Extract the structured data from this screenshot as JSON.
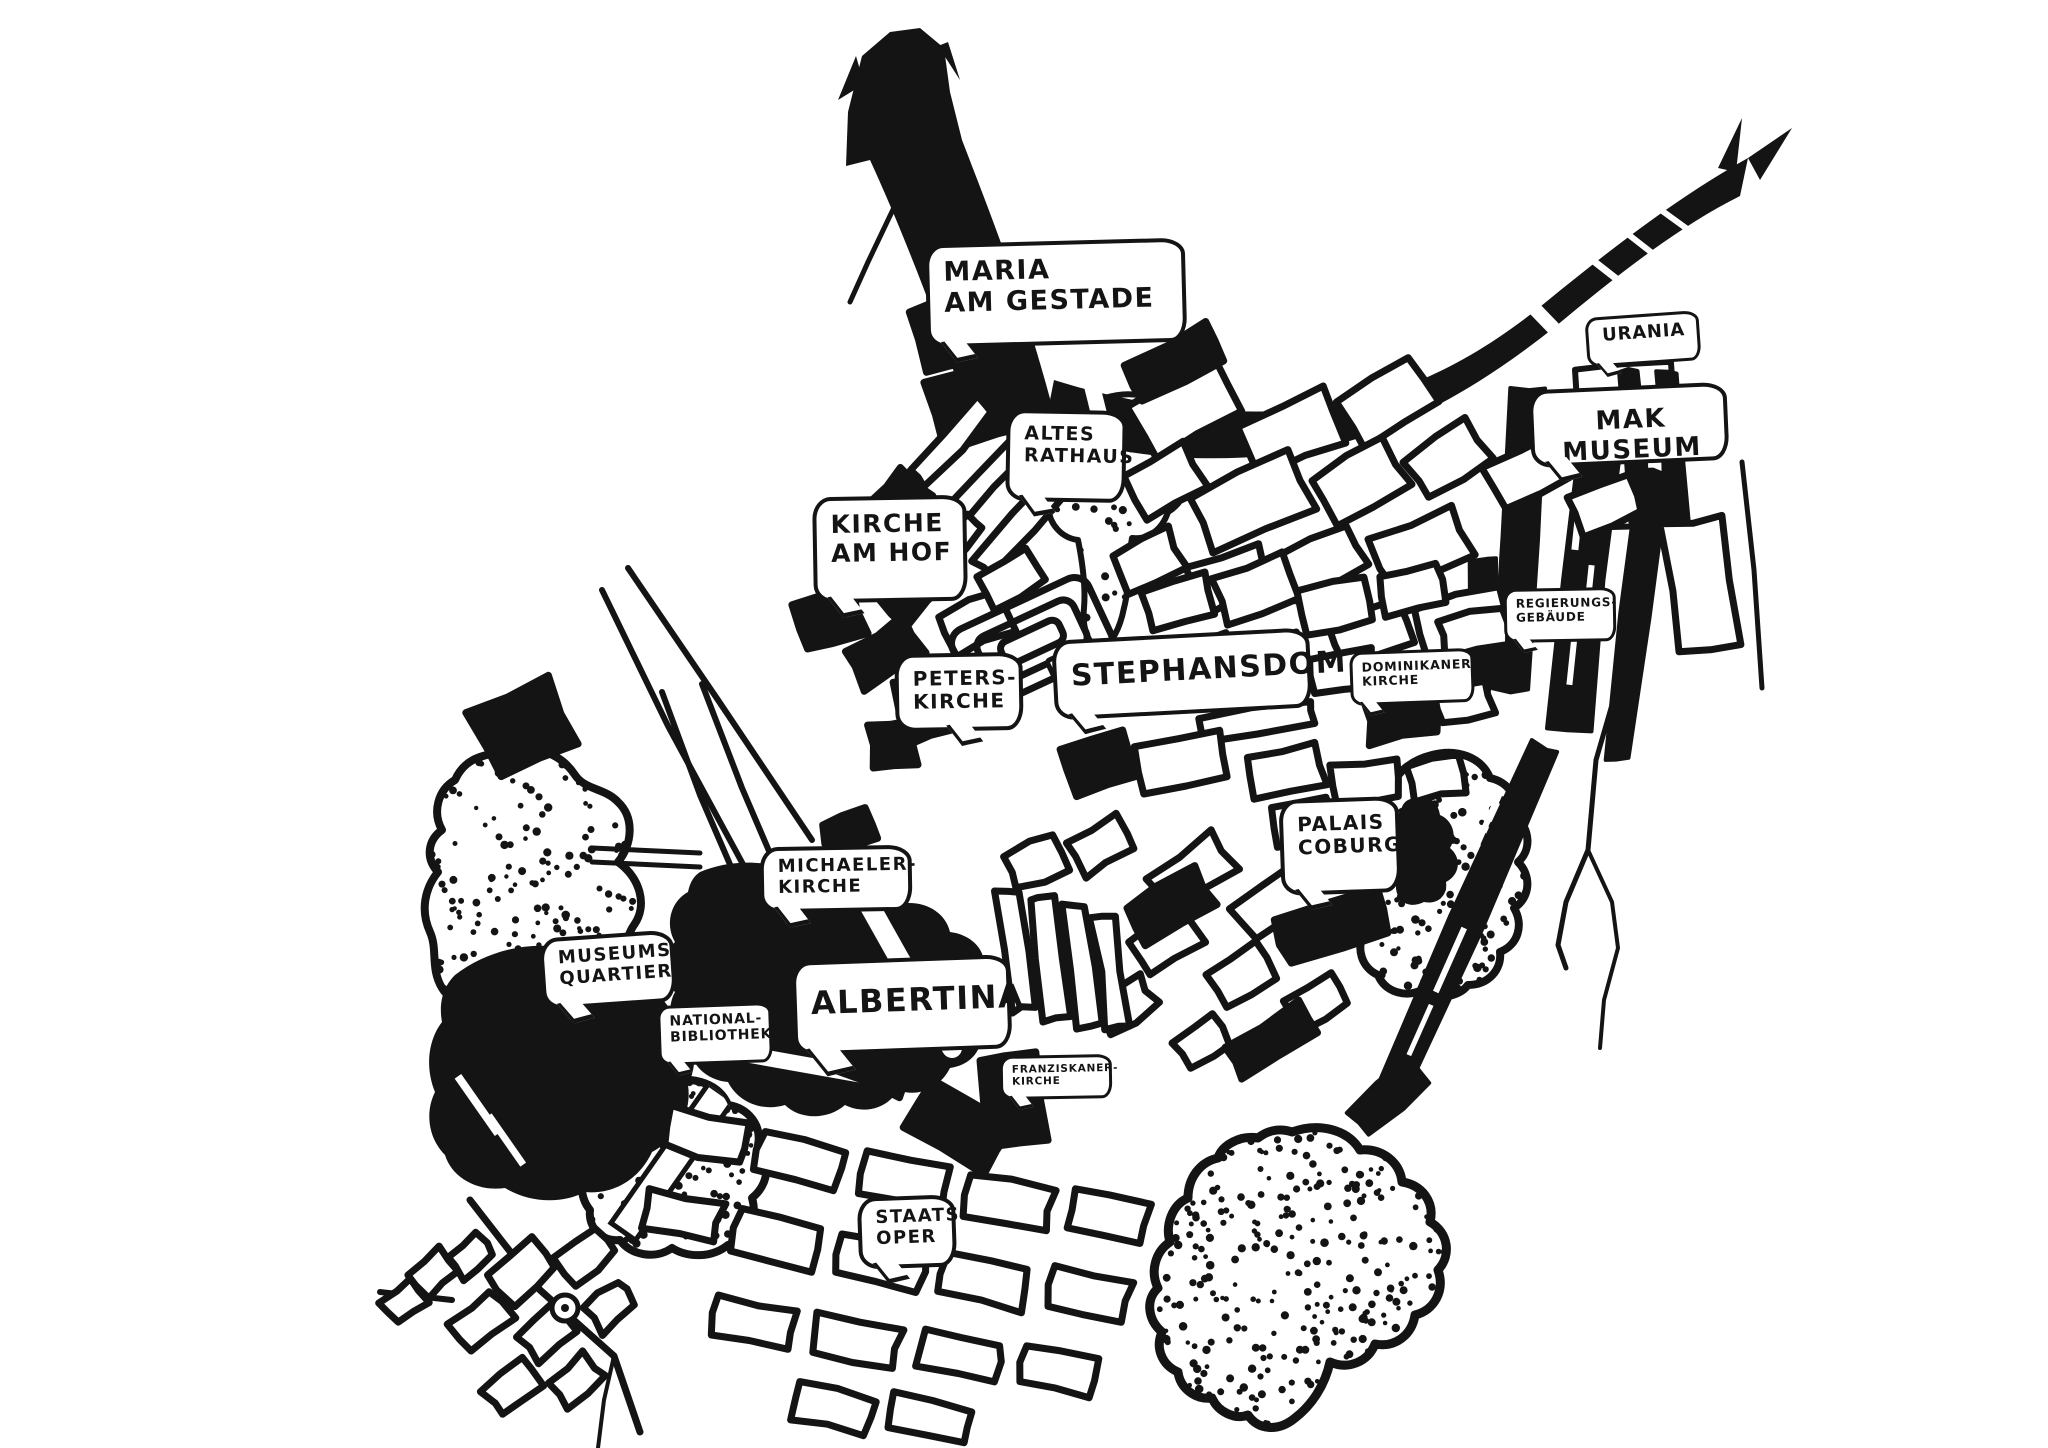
{
  "map": {
    "kind": "hand-drawn ink map",
    "city_center": "Vienna Innere Stadt"
  },
  "colors": {
    "ink": "#141414",
    "paper": "#ffffff"
  },
  "labels": {
    "maria_am_gestade": {
      "line1": "MARIA",
      "line2": "AM GESTADE"
    },
    "urania": {
      "line1": "URANIA"
    },
    "mak_museum": {
      "line1": "MAK MUSEUM"
    },
    "altes_rathaus": {
      "line1": "ALTES",
      "line2": "RATHAUS"
    },
    "kirche_am_hof": {
      "line1": "KIRCHE",
      "line2": "AM HOF"
    },
    "regierungsgebaeude": {
      "line1": "REGIERUNGS-",
      "line2": "GEBÄUDE"
    },
    "peterskirche": {
      "line1": "PETERS-",
      "line2": "KIRCHE"
    },
    "stephansdom": {
      "line1": "STEPHANSDOM"
    },
    "dominikanerkirche": {
      "line1": "DOMINIKANER-",
      "line2": "KIRCHE"
    },
    "palais_coburg": {
      "line1": "PALAIS",
      "line2": "COBURG"
    },
    "michaelerkirche": {
      "line1": "MICHAELER-",
      "line2": "KIRCHE"
    },
    "museumsquartier": {
      "line1": "MUSEUMS-",
      "line2": "QUARTIER"
    },
    "nationalbibliothek": {
      "line1": "NATIONAL-",
      "line2": "BIBLIOTHEK"
    },
    "albertina": {
      "line1": "ALBERTINA"
    },
    "franziskanerkirche": {
      "line1": "FRANZISKANER-",
      "line2": "KIRCHE"
    },
    "staatsoper": {
      "line1": "STAATS-",
      "line2": "OPER"
    }
  }
}
